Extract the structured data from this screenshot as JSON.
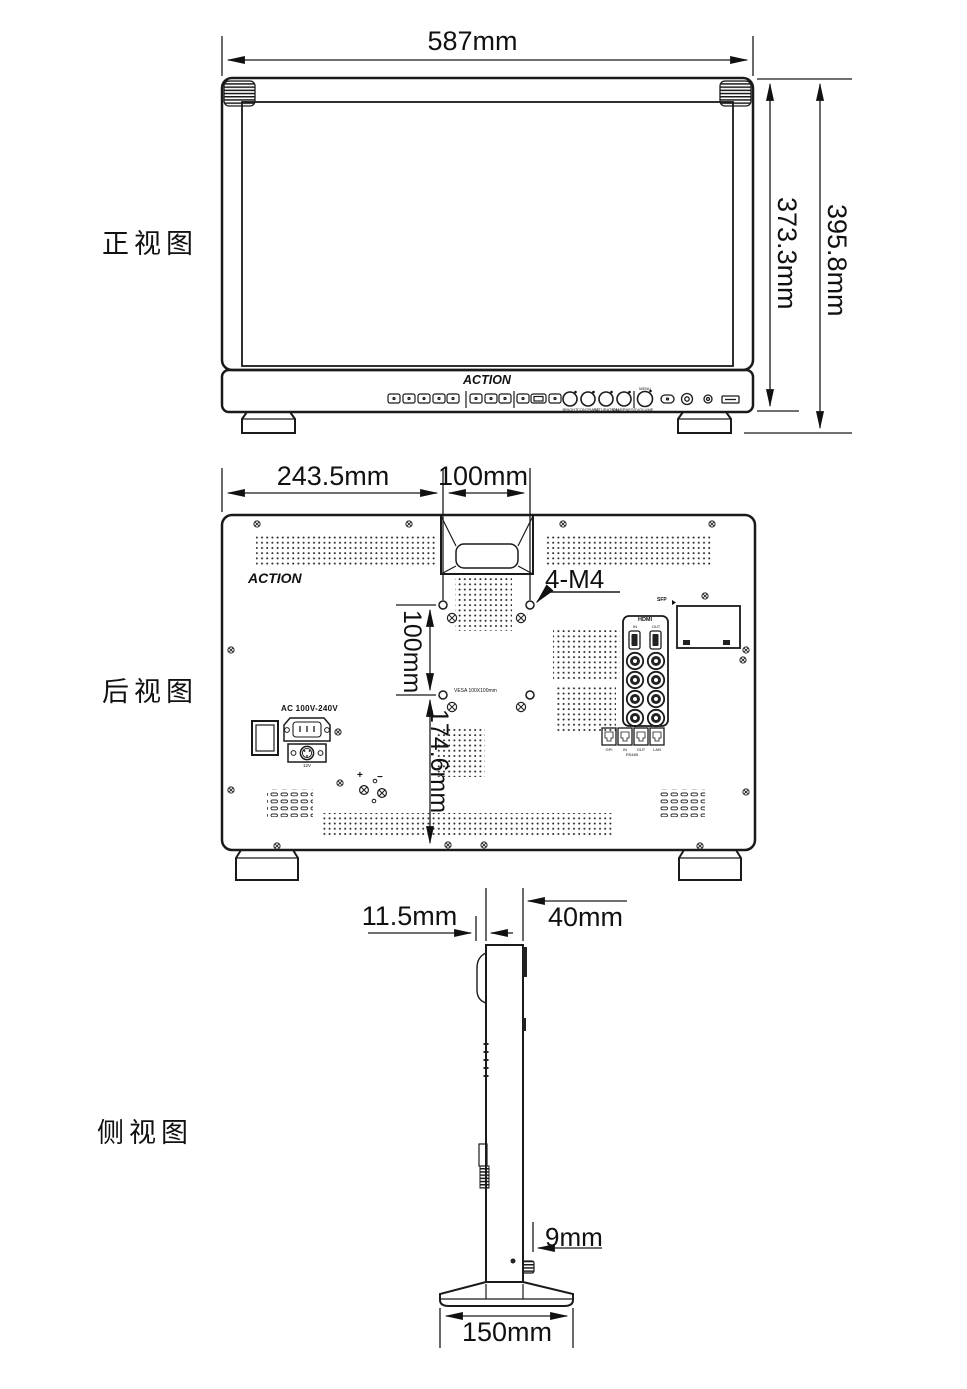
{
  "page": {
    "bg": "#ffffff",
    "line_color": "#1a1a1a"
  },
  "front": {
    "title": "正视图",
    "brand": "ACTION",
    "dim_width": "587mm",
    "dim_body_height": "373.3mm",
    "dim_total_height": "395.8mm",
    "menu_label": "MENU",
    "knob_labels": [
      "BRIGHT",
      "CONTRAST",
      "SATURATION",
      "SHARPNESS",
      "VOLUME"
    ]
  },
  "rear": {
    "title": "后视图",
    "brand": "ACTION",
    "dim_left_to_vesa": "243.5mm",
    "dim_vesa_width": "100mm",
    "dim_vesa_height": "100mm",
    "dim_vesa_to_bottom": "174.6mm",
    "vesa_screw_note": "4-M4",
    "vesa_text": "VESA 100X100mm",
    "power_label": "AC 100V-240V",
    "dc_label": "12V",
    "plus": "+",
    "minus": "−",
    "hdmi": {
      "title": "HDMI",
      "in": "IN",
      "out": "OUT"
    },
    "sfp": "SFP",
    "jack_labels": [
      "GPI",
      "IN",
      "OUT",
      "LAN"
    ],
    "jack_sub": "RS485"
  },
  "side": {
    "title": "侧视图",
    "dim_bezel": "11.5mm",
    "dim_depth": "40mm",
    "dim_knob": "9mm",
    "dim_base": "150mm"
  }
}
